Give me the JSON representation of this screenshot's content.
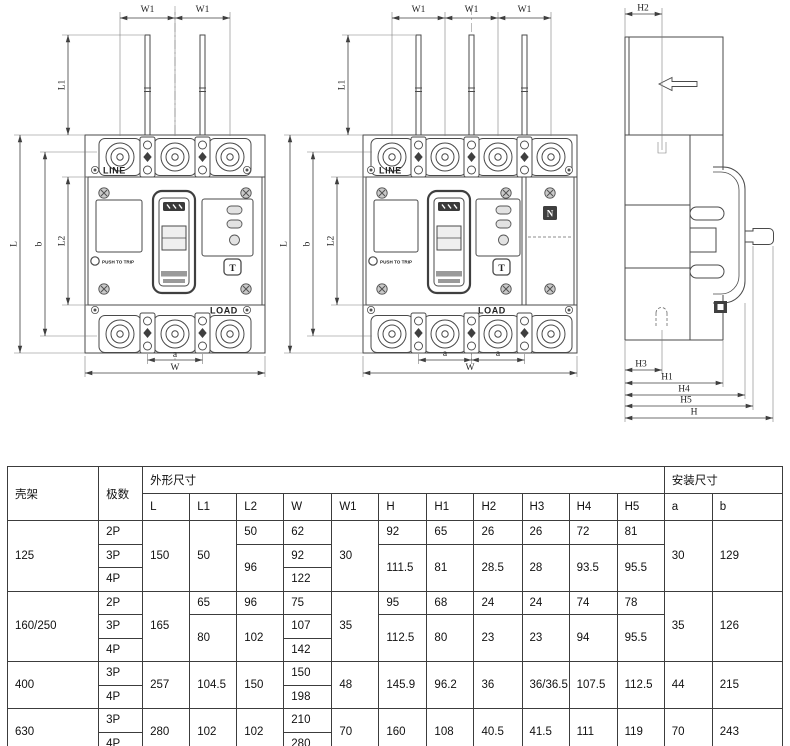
{
  "front_view_3p": {
    "dims": {
      "w1_left": "W1",
      "w1_right": "W1",
      "l1": "L1",
      "l": "L",
      "b": "b",
      "l2": "L2",
      "a": "a",
      "w": "W"
    },
    "labels": {
      "line": "LINE",
      "load": "LOAD",
      "push_to_trip": "PUSH TO TRIP",
      "test_button": "T"
    }
  },
  "front_view_4p": {
    "dims": {
      "w1_1": "W1",
      "w1_2": "W1",
      "w1_3": "W1",
      "l1": "L1",
      "l": "L",
      "b": "b",
      "l2": "L2",
      "a_left": "a",
      "a_right": "a",
      "w": "W"
    },
    "labels": {
      "line": "LINE",
      "load": "LOAD",
      "push_to_trip": "PUSH TO TRIP",
      "test_button": "T",
      "neutral": "N"
    }
  },
  "side_view": {
    "dims": {
      "h2": "H2",
      "h3": "H3",
      "h1": "H1",
      "h4": "H4",
      "h5": "H5",
      "h": "H"
    }
  },
  "table": {
    "header": {
      "frame": "壳架",
      "poles": "极数",
      "outline_group": "外形尺寸",
      "mounting_group": "安装尺寸",
      "outline_cols": [
        "L",
        "L1",
        "L2",
        "W",
        "W1",
        "H",
        "H1",
        "H2",
        "H3",
        "H4",
        "H5"
      ],
      "mounting_cols": [
        "a",
        "b"
      ]
    },
    "groups": [
      {
        "frame": "125",
        "poles": [
          "2P",
          "3P",
          "4P"
        ],
        "L": "150",
        "L1": "50",
        "L2_2p": "50",
        "L2_34p": "96",
        "W": [
          "62",
          "92",
          "122"
        ],
        "W1": "30",
        "H_2p": "92",
        "H_34p": "111.5",
        "H1_2p": "65",
        "H1_34p": "81",
        "H2_2p": "26",
        "H2_34p": "28.5",
        "H3_2p": "26",
        "H3_34p": "28",
        "H4_2p": "72",
        "H4_34p": "93.5",
        "H5_2p": "81",
        "H5_34p": "95.5",
        "a": "30",
        "b": "129"
      },
      {
        "frame": "160/250",
        "poles": [
          "2P",
          "3P",
          "4P"
        ],
        "L": "165",
        "L1_2p": "65",
        "L1_34p": "80",
        "L2_2p": "96",
        "L2_34p": "102",
        "W": [
          "75",
          "107",
          "142"
        ],
        "W1": "35",
        "H_2p": "95",
        "H_34p": "112.5",
        "H1_2p": "68",
        "H1_34p": "80",
        "H2_2p": "24",
        "H2_34p": "23",
        "H3_2p": "24",
        "H3_34p": "23",
        "H4_2p": "74",
        "H4_34p": "94",
        "H5_2p": "78",
        "H5_34p": "95.5",
        "a": "35",
        "b": "126"
      },
      {
        "frame": "400",
        "poles": [
          "3P",
          "4P"
        ],
        "L": "257",
        "L1": "104.5",
        "L2": "150",
        "W": [
          "150",
          "198"
        ],
        "W1": "48",
        "H": "145.9",
        "H1": "96.2",
        "H2": "36",
        "H3": "36/36.5",
        "H4": "107.5",
        "H5": "112.5",
        "a": "44",
        "b": "215"
      },
      {
        "frame": "630",
        "poles": [
          "3P",
          "4P"
        ],
        "L": "280",
        "L1": "102",
        "L2": "102",
        "W": [
          "210",
          "280"
        ],
        "W1": "70",
        "H": "160",
        "H1": "108",
        "H2": "40.5",
        "H3": "41.5",
        "H4": "111",
        "H5": "119",
        "a": "70",
        "b": "243"
      }
    ]
  }
}
